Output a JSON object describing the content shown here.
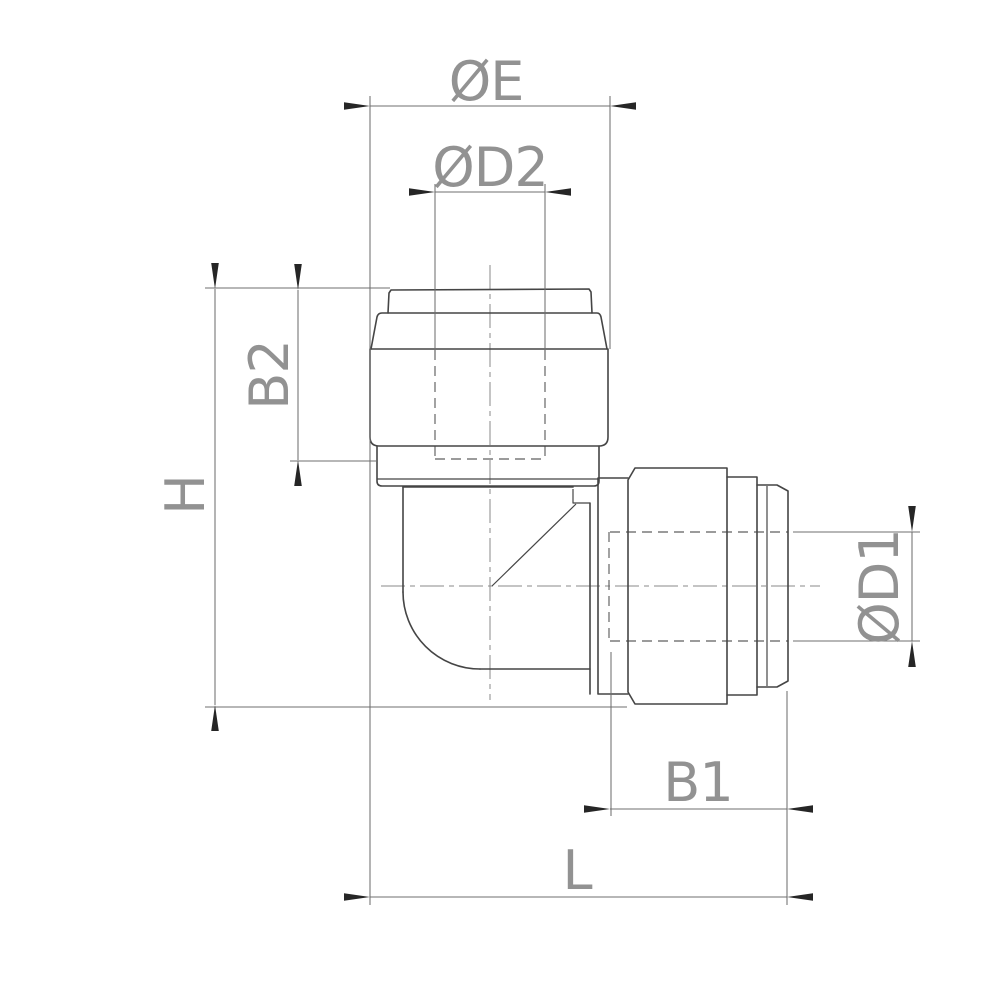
{
  "drawing": {
    "title": "Elbow push-fit fitting — dimensioned outline drawing",
    "view": "side elevation",
    "background": "#ffffff",
    "colors": {
      "outline": "#454545",
      "dimension_line": "#6f6f6f",
      "hidden_line": "#5f5f5f",
      "center_line": "#8a8a8a",
      "label_text": "#929292",
      "arrowhead": "#262626"
    },
    "labels": {
      "dia_e": "ØE",
      "dia_d2": "ØD2",
      "b2": "B2",
      "h": "H",
      "dia_d1": "ØD1",
      "b1": "B1",
      "l": "L"
    }
  }
}
